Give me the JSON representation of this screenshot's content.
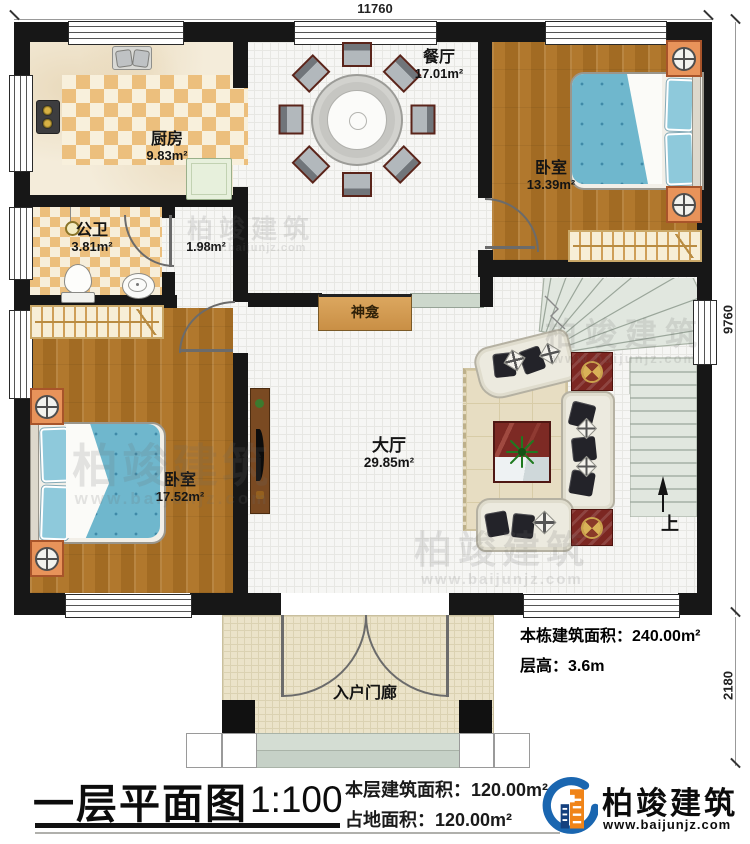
{
  "plan": {
    "dimensions": {
      "top": "11760",
      "right_upper": "9760",
      "right_lower": "2180"
    },
    "rooms": {
      "kitchen": {
        "name": "厨房",
        "area": "9.83m²"
      },
      "bath": {
        "name": "公卫",
        "area": "3.81m²"
      },
      "corridor": {
        "area": "1.98m²"
      },
      "dining": {
        "name": "餐厅",
        "area": "17.01m²"
      },
      "bedroom_right": {
        "name": "卧室",
        "area": "13.39m²"
      },
      "bedroom_left": {
        "name": "卧室",
        "area": "17.52m²"
      },
      "living": {
        "name": "大厅",
        "area": "29.85m²"
      },
      "porch": {
        "name": "入户门廊"
      },
      "shrine": {
        "name": "神龛"
      }
    },
    "stairs": {
      "up_label": "上"
    },
    "notes": {
      "building_area_label": "本栋建筑面积：",
      "building_area_value": "240.00m²",
      "floor_height_label": "层高：",
      "floor_height_value": "3.6m"
    }
  },
  "titleblock": {
    "title": "一层平面图",
    "scale": "1:100",
    "floor_area_label": "本层建筑面积：",
    "floor_area_value": "120.00m²",
    "land_area_label": "占地面积：",
    "land_area_value": "120.00m²"
  },
  "brand": {
    "name": "柏竣建筑",
    "url": "www.baijunjz.com"
  },
  "watermark": {
    "text": "柏竣建筑",
    "url": "www.baijunjz.com"
  }
}
